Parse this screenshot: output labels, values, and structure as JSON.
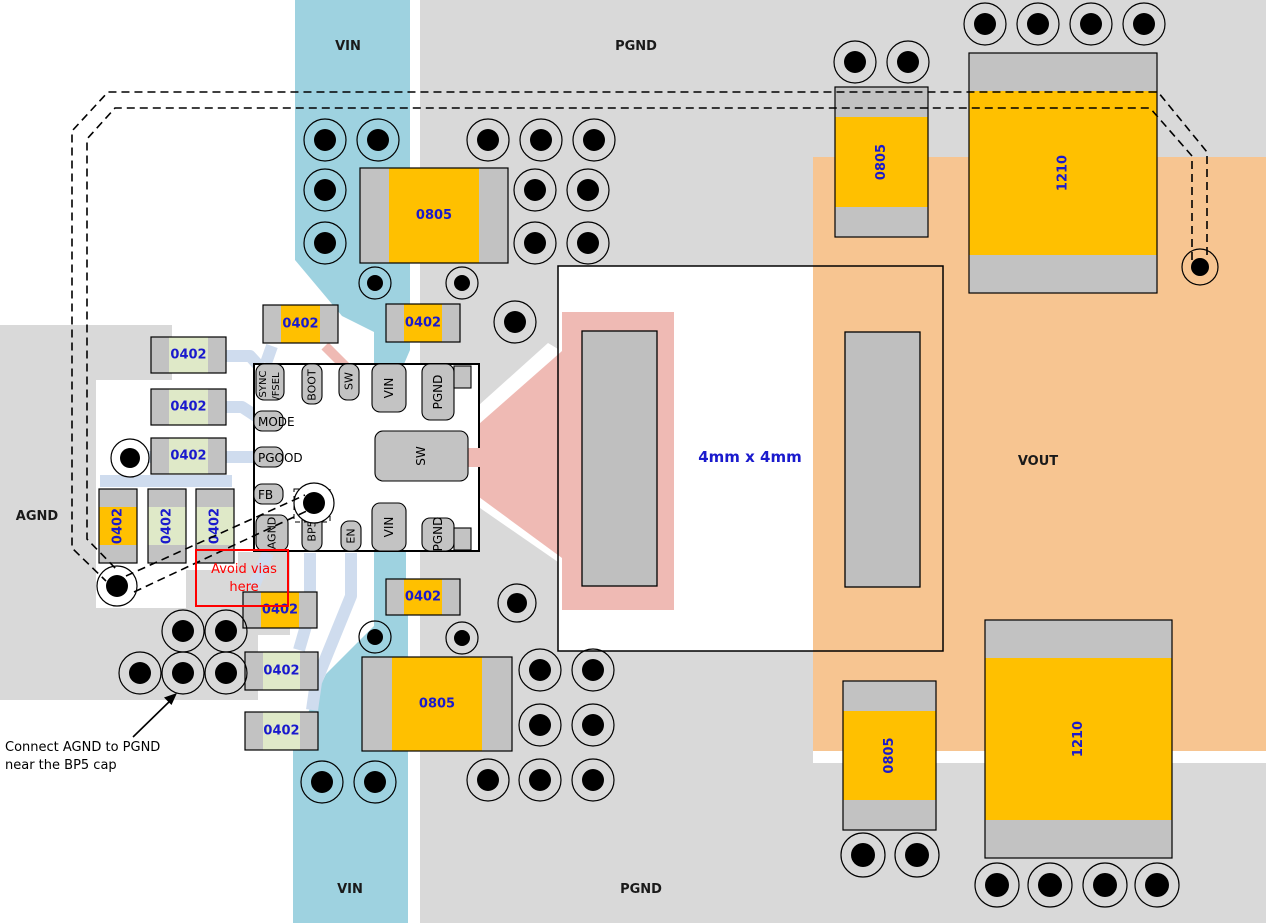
{
  "regions": {
    "vin_top": "VIN",
    "pgnd_top": "PGND",
    "agnd": "AGND",
    "vout": "VOUT",
    "vin_bottom": "VIN",
    "pgnd_bottom": "PGND"
  },
  "ic": {
    "size_label": "4mm x 4mm",
    "pin_sync_line1": "SYNC",
    "pin_sync_line2": "/FSEL",
    "pins_top": [
      "BOOT",
      "SW",
      "VIN",
      "PGND"
    ],
    "pins_left": [
      "MODE",
      "PGOOD",
      "FB"
    ],
    "pins_bottom": [
      "AGND",
      "BP5",
      "EN",
      "VIN",
      "PGND"
    ],
    "pin_right": "SW"
  },
  "component_sizes": [
    "0805",
    "0402",
    "0402",
    "0402",
    "0402",
    "0402",
    "0402",
    "0402",
    "0402",
    "0402",
    "0402",
    "0402",
    "0402",
    "0805",
    "0805",
    "1210",
    "0805",
    "1210"
  ],
  "annotations": {
    "avoid_vias_line1": "Avoid vias",
    "avoid_vias_line2": "here",
    "connect_line1": "Connect AGND to PGND",
    "connect_line2": "near the BP5 cap"
  },
  "colors": {
    "vin_copper": "#9ed2e0",
    "ground_copper": "#d9d9d9",
    "vout_copper": "#f7c591",
    "sw_copper": "#efbab4",
    "trace_light": "#cfdcee",
    "component_cap_gray": "#c2c2c2",
    "component_body_orange": "#ffc000",
    "component_body_green": "#dfe9c8",
    "ic_pad_gray": "#c3c3c3",
    "inductor_pad_gray": "#bfbfbf",
    "label_blue": "#1a1acd",
    "warning_red": "#ff0000",
    "text_black": "#000000"
  }
}
